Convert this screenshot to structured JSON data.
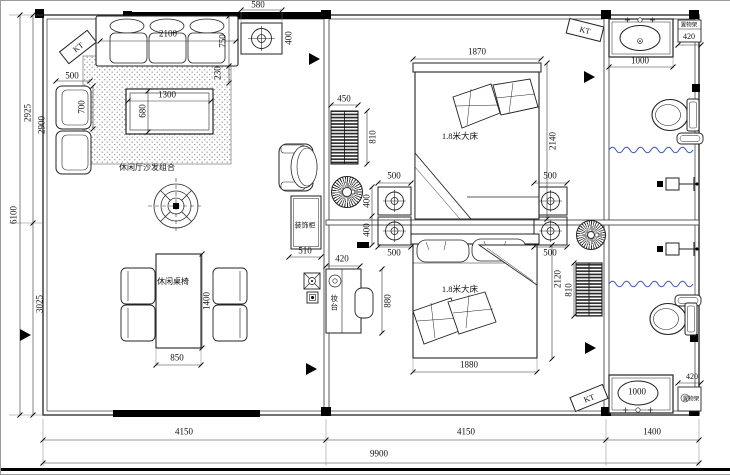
{
  "labels": {
    "living_area": "休闲厅沙发组合",
    "dining_set": "休闲桌椅",
    "bed": "1.8米大床",
    "decor_cabinet": "装饰柜",
    "dressing_table": "妆台",
    "shelf": "置物架",
    "ac": "KT"
  },
  "dims": {
    "sofa_width": "2100",
    "sofa_depth": "750",
    "sofa_offset": "230",
    "ceiling_light_top_w": "580",
    "ceiling_light_top_h": "400",
    "armchair_w": "500",
    "armchair_d": "700",
    "coffee_table_w": "1300",
    "coffee_table_d": "680",
    "radiator1_w": "450",
    "radiator1_h": "810",
    "radiator2_h": "810",
    "wall_light_w": "500",
    "wall_light_h": "400",
    "cabinet_w": "510",
    "dresser_w": "420",
    "dresser_h": "880",
    "bed1_w": "1870",
    "bed1_h": "2140",
    "bed2_w": "1880",
    "bed2_h": "2120",
    "sink_w": "1000",
    "shelf_w": "420",
    "dining_w": "850",
    "dining_h": "1400",
    "bottom_segments": [
      "4150",
      "4150",
      "1400"
    ],
    "total_width": "9900",
    "left_top_outer": "2925",
    "left_top_inner": "2900",
    "left_bottom": "3025",
    "total_height": "6100"
  },
  "colors": {
    "line": "#1a1a1a",
    "shower_wave_blue": "#3352c8",
    "hatch_grey": "#999999"
  }
}
